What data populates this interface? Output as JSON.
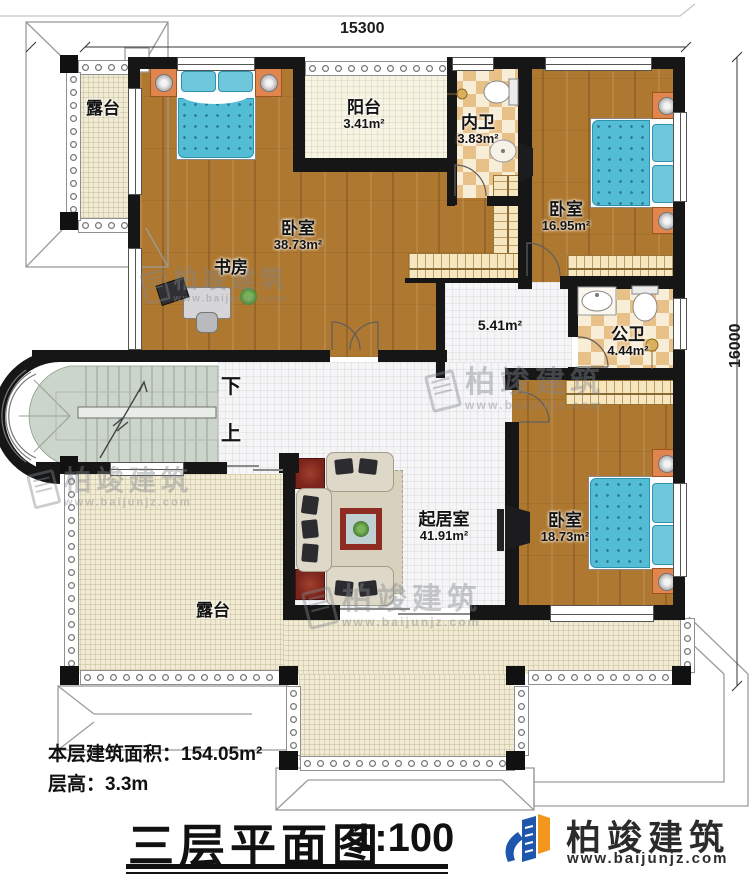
{
  "dimensions": {
    "width_top": "15300",
    "height_right": "16000"
  },
  "rooms": {
    "terrace_nw": {
      "name": "露台"
    },
    "master_bedroom": {
      "name": "卧室",
      "area": "38.73m²"
    },
    "study": {
      "name": "书房"
    },
    "balcony": {
      "name": "阳台",
      "area": "3.41m²"
    },
    "ensuite_bath": {
      "name": "内卫",
      "area": "3.83m²"
    },
    "bedroom_ne": {
      "name": "卧室",
      "area": "16.95m²"
    },
    "public_bath": {
      "name": "公卫",
      "area": "4.44m²"
    },
    "hallway": {
      "area": "5.41m²"
    },
    "living_room": {
      "name": "起居室",
      "area": "41.91m²"
    },
    "bedroom_se": {
      "name": "卧室",
      "area": "18.73m²"
    },
    "terrace_south": {
      "name": "露台"
    }
  },
  "stairs": {
    "down_label": "下",
    "up_label": "上"
  },
  "notes": {
    "floor_area": "本层建筑面积：154.05m²",
    "floor_height": "层高：3.3m"
  },
  "title_block": {
    "title": "三层平面图",
    "scale": "1:100"
  },
  "branding": {
    "company": "柏竣建筑",
    "website": "www.baijunjz.com"
  },
  "watermark": {
    "company": "柏竣建筑",
    "website": "www.baijunjz.com"
  },
  "colors": {
    "wall": "#161616",
    "wood": "#ae7830",
    "checker_dark": "#e8c189",
    "checker_light": "#f8eed8",
    "terrace": "#f1ebd3",
    "tile": "#f5f5f7",
    "stair": "#ccd5cb",
    "bed_blue": "#54bdd6",
    "logo_blue": "#1e56ae",
    "logo_orange": "#f2961d"
  }
}
